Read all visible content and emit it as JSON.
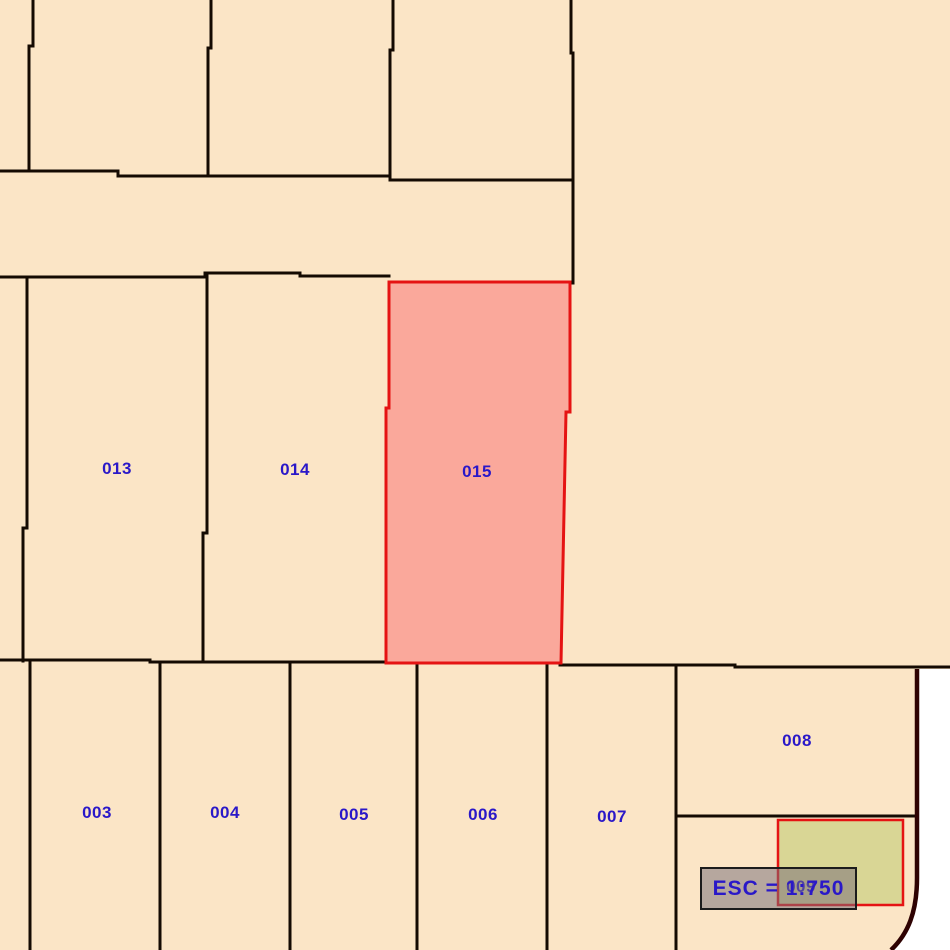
{
  "map": {
    "background_color": "#FBE5C6",
    "outside_color": "#FFFFFF",
    "parcel_line_color": "#140A02",
    "boundary_line_color": "#2E0202",
    "label_color": "#2A18C8",
    "highlight_parcel": {
      "id": "015",
      "fill": "#FAA89B",
      "border": "#E51313"
    },
    "secondary_parcel": {
      "id": "009",
      "fill": "#D9D695",
      "border": "#E51313"
    }
  },
  "parcels": [
    {
      "id": "003",
      "label": "003"
    },
    {
      "id": "004",
      "label": "004"
    },
    {
      "id": "005",
      "label": "005"
    },
    {
      "id": "006",
      "label": "006"
    },
    {
      "id": "007",
      "label": "007"
    },
    {
      "id": "008",
      "label": "008"
    },
    {
      "id": "009",
      "label": "009"
    },
    {
      "id": "013",
      "label": "013"
    },
    {
      "id": "014",
      "label": "014"
    },
    {
      "id": "015",
      "label": "015"
    }
  ],
  "scale_label": {
    "text": "ESC = 1:750"
  }
}
